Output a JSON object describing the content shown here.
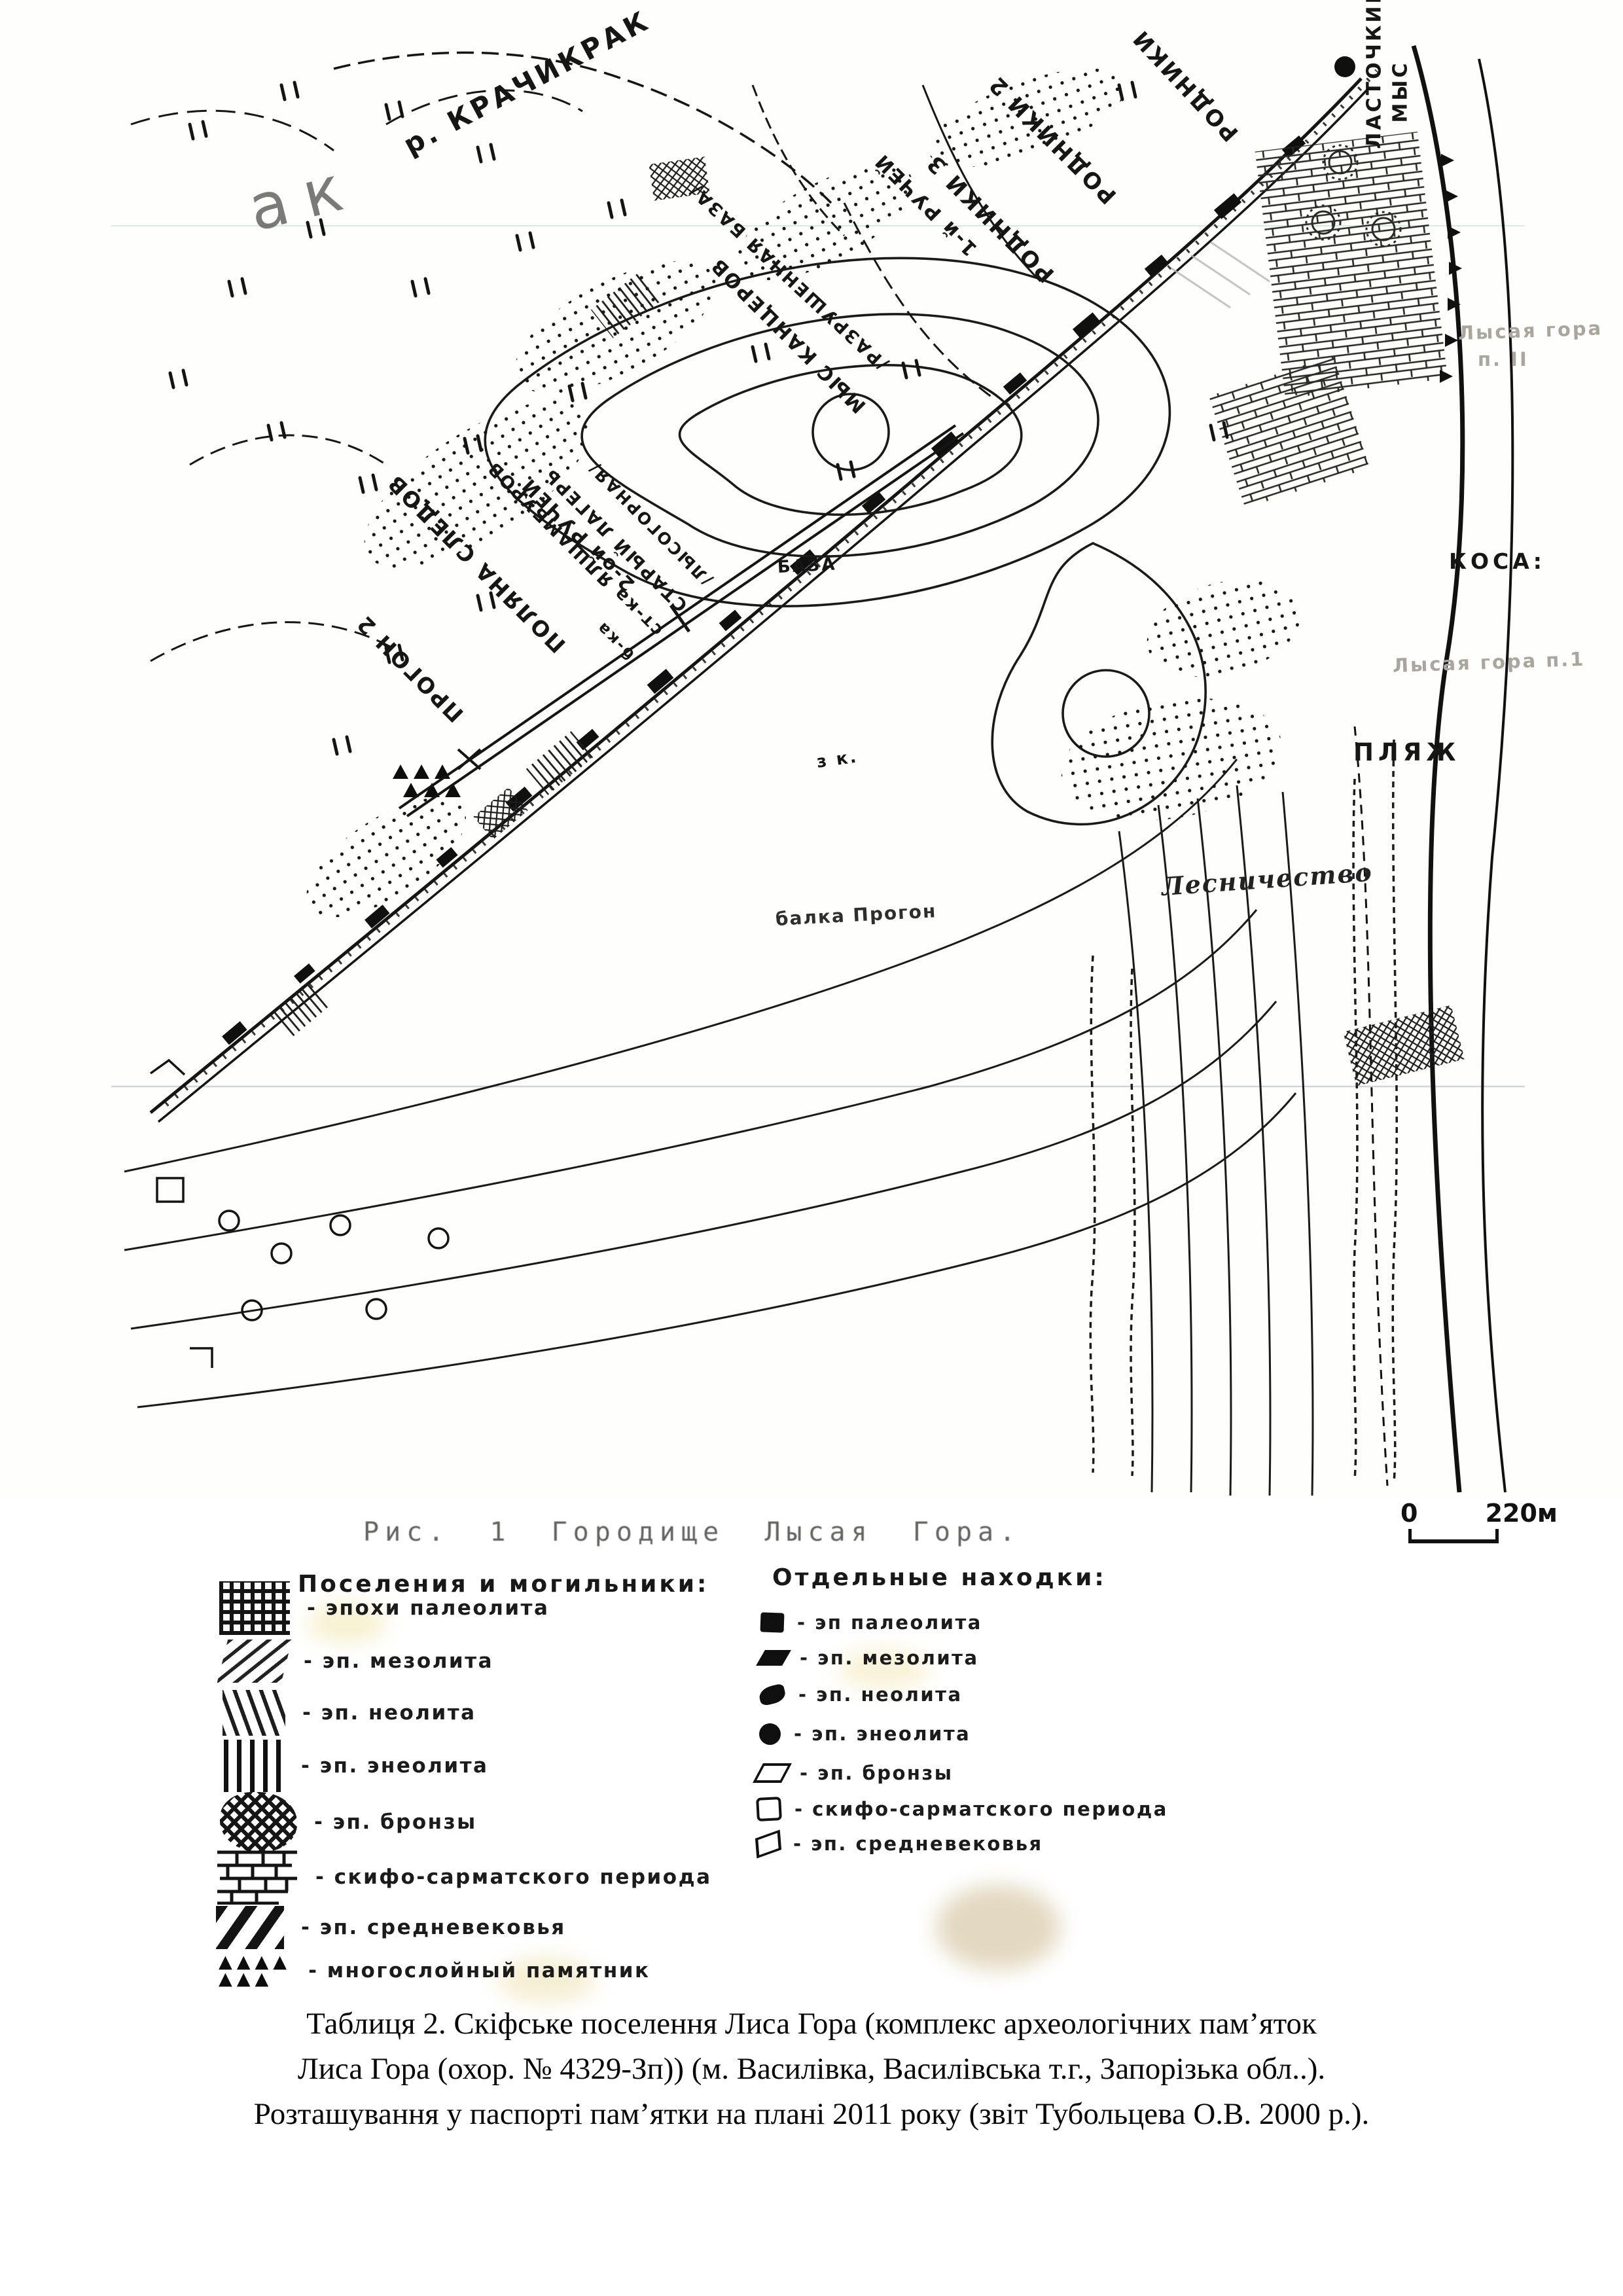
{
  "map": {
    "figure_title": "Рис. 1   Городище Лысая Гора.",
    "scale": {
      "start": "0",
      "end": "220м"
    },
    "labels": [
      {
        "name": "river-krachykrak",
        "text": "р. КРАЧИКРАК"
      },
      {
        "name": "rodniki-2",
        "text": "РОДНИКИ 2"
      },
      {
        "name": "rodniki-3",
        "text": "РОДНИКИ 3"
      },
      {
        "name": "rodniki",
        "text": "РОДНИКИ"
      },
      {
        "name": "ruchey-1",
        "text": "1-й РУЧЕЙ"
      },
      {
        "name": "razrushennaya-baza",
        "text": "/РАЗРУШЕННАЯ БАЗА/"
      },
      {
        "name": "mys-kantserov",
        "text": "МЫС КАНЦЕРОВ"
      },
      {
        "name": "stoyanka",
        "text": "ст-ка ЯЛШАМБУРОВ"
      },
      {
        "name": "staryi-lager",
        "text": "СТАРЫЙ ЛАГЕРЬ"
      },
      {
        "name": "lysogornaya",
        "text": "/ЛЫСОГОРНАЯ/"
      },
      {
        "name": "balka-short",
        "text": "б-ка"
      },
      {
        "name": "ruchey-2",
        "text": "2-ой РУЧЕЙ"
      },
      {
        "name": "polyana-sledov",
        "text": "ПОЛЯНА СЛЕДОВ"
      },
      {
        "name": "progon-2",
        "text": "ПРОГОН 2"
      },
      {
        "name": "lastochkin",
        "text": "ЛАСТОЧКИН"
      },
      {
        "name": "mys",
        "text": "МЫС"
      },
      {
        "name": "kosa",
        "text": "КОСА:"
      },
      {
        "name": "lysaya-gora-p1",
        "text": "Лысая гора п.1"
      },
      {
        "name": "plyazh",
        "text": "ПЛЯЖ"
      },
      {
        "name": "lysaya-gora-line1",
        "text": "Лысая гора"
      },
      {
        "name": "lysaya-gora-line2",
        "text": "п. II"
      },
      {
        "name": "lesnichestvo",
        "text": "Лесничество"
      },
      {
        "name": "balka-progon",
        "text": "балка Прогон"
      },
      {
        "name": "baza",
        "text": "БАЗА"
      },
      {
        "name": "z-k",
        "text": "з к."
      },
      {
        "name": "big-letters",
        "text": "ак"
      }
    ]
  },
  "legend": {
    "settlements": {
      "header": "Поселения и могильники:",
      "items": [
        {
          "icon": "grid-hatch",
          "label": "- эпохи палеолита"
        },
        {
          "icon": "diagonal-hatch",
          "label": "- эп. мезолита"
        },
        {
          "icon": "steep-hatch",
          "label": "- эп. неолита"
        },
        {
          "icon": "vertical-hatch",
          "label": "- эп. энеолита"
        },
        {
          "icon": "cross-hatch",
          "label": "- эп. бронзы"
        },
        {
          "icon": "brick-pattern",
          "label": "- скифо-сарматского периода"
        },
        {
          "icon": "bold-diagonal",
          "label": "- эп. средневековья"
        },
        {
          "icon": "triangles",
          "label": "- многослойный памятник"
        }
      ]
    },
    "finds": {
      "header": "Отдельные находки:",
      "items": [
        {
          "icon": "filled-square",
          "label": "- эп палеолита"
        },
        {
          "icon": "filled-parallelogram",
          "label": "- эп. мезолита"
        },
        {
          "icon": "filled-blob",
          "label": "- эп. неолита"
        },
        {
          "icon": "filled-circle",
          "label": "- эп. энеолита"
        },
        {
          "icon": "open-parallelogram",
          "label": "- эп. бронзы"
        },
        {
          "icon": "open-square",
          "label": "- скифо-сарматского периода"
        },
        {
          "icon": "open-tilted-square",
          "label": "- эп. средневековья"
        }
      ]
    }
  },
  "caption": {
    "lines": [
      "Таблиця 2. Скіфське поселення Лиса Гора (комплекс археологічних пам’яток",
      "Лиса Гора (охор. № 4329-Зп)) (м. Василівка, Василівська т.г., Запорізька обл..).",
      "Розташування у паспорті пам’ятки на плані 2011 року (звіт Тубольцева О.В. 2000 р.)."
    ]
  }
}
